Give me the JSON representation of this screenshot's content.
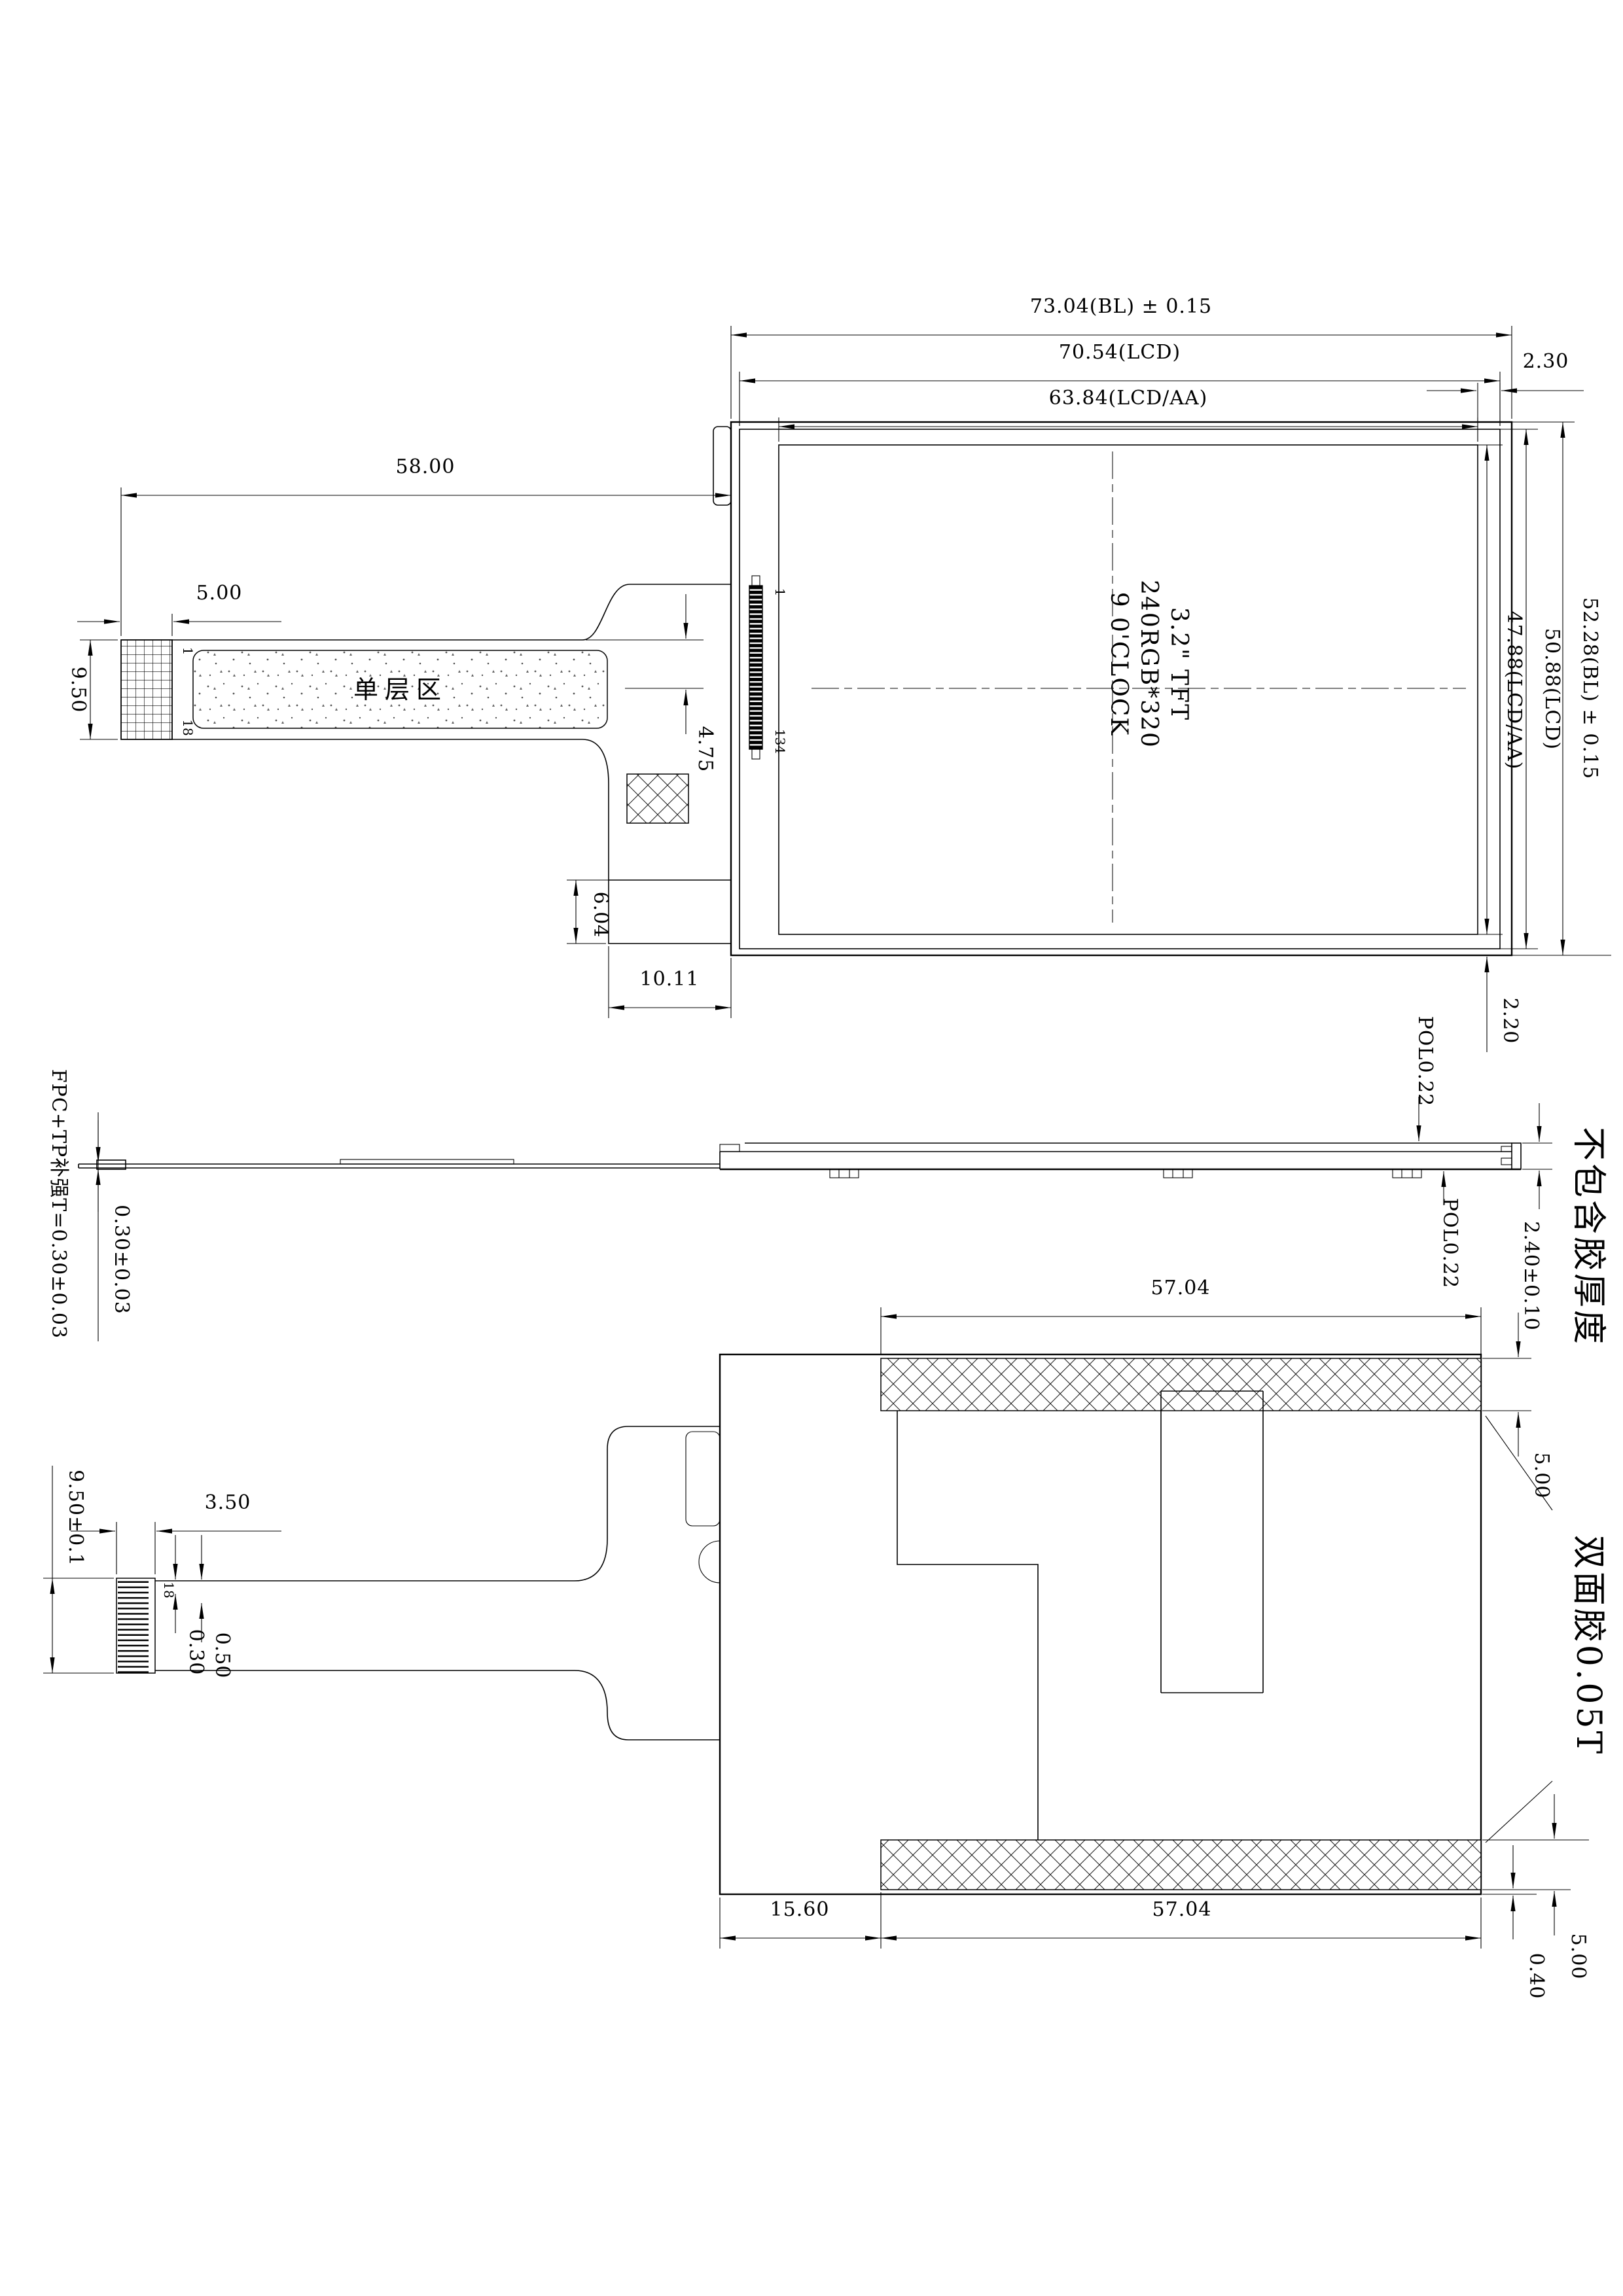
{
  "top": {
    "dims": {
      "bl_width": "73.04(BL) ± 0.15",
      "lcd_width": "70.54(LCD)",
      "aa_width": "63.84(LCD/AA)",
      "edge_gap_right": "2.30",
      "fpc_length": "58.00",
      "finger_length": "5.00",
      "connector_height": "9.50",
      "fpc_step": "4.75",
      "component_height": "6.04",
      "tail_to_edge": "10.11",
      "edge_gap_bottom": "2.20",
      "aa_height": "47.88(LCD/AA)",
      "lcd_height": "50.88(LCD)",
      "bl_height": "52.28(BL) ± 0.15"
    },
    "labels": {
      "single_layer_zone": "单层区",
      "pin_first": "1",
      "pin_last": "18",
      "ic_pin_first": "1",
      "ic_pin_last": "134",
      "panel_line1": "3.2\" TFT",
      "panel_line2": "240RGB*320",
      "panel_line3": "9 0'CLOCK"
    }
  },
  "side": {
    "fpc_note": "FPC+TP补强T=0.30±0.03",
    "fpc_thickness": "0.30±0.03",
    "pol_top": "POL0.22",
    "pol_bottom": "POL0.22",
    "module_thickness": "2.40±0.10",
    "thickness_note": "不包含胶厚度"
  },
  "bottom": {
    "tape_width_top": "57.04",
    "tape_height_top": "5.00",
    "tape_label": "双面胶0.05T",
    "connector_height": "9.50±0.1",
    "stiffener_width": "3.50",
    "pin_width": "0.30",
    "pin_pitch": "0.50",
    "pin_last": "18",
    "left_offset": "15.60",
    "tape_width_bottom": "57.04",
    "tape_height_bottom": "5.00",
    "tape_offset_bottom": "0.40"
  }
}
